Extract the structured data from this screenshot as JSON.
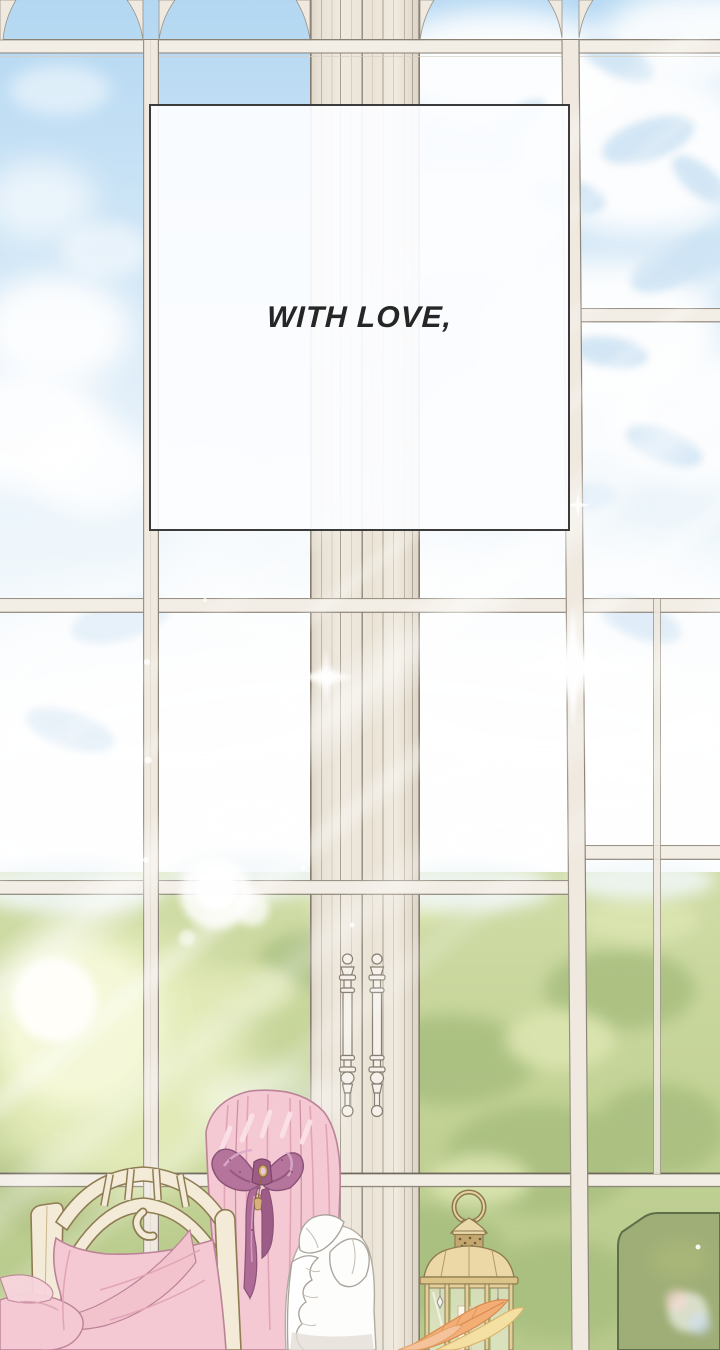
{
  "panel": {
    "caption": "WITH LOVE,"
  },
  "colors": {
    "sky_top": "#b3d7f2",
    "sky_haze": "#eaf3fa",
    "cloud_white": "#ffffff",
    "leaf_shadow_blue": "#cfe4f4",
    "tree_green": "#c6d49a",
    "tree_green_dark": "#a9bf80",
    "sun_glow": "#fdfef2",
    "frame_cream": "#f1ece4",
    "frame_edge": "#8f877a",
    "garden_panel_green": "#9fae77",
    "caption_box_bg": "#fcfdff",
    "caption_box_border": "#3b3b3b",
    "caption_text": "#262626",
    "hair_pink": "#f4c9d3",
    "hair_strand": "#e0a4b6",
    "bow_mauve": "#b5749c",
    "dress_white": "#fdfdfc",
    "chair_cream": "#f3ebd8",
    "chair_outline": "#8f7c52",
    "lantern_gold": "#ebd8a6",
    "lantern_outline": "#8c7950",
    "feather_orange": "#f2ae74"
  }
}
